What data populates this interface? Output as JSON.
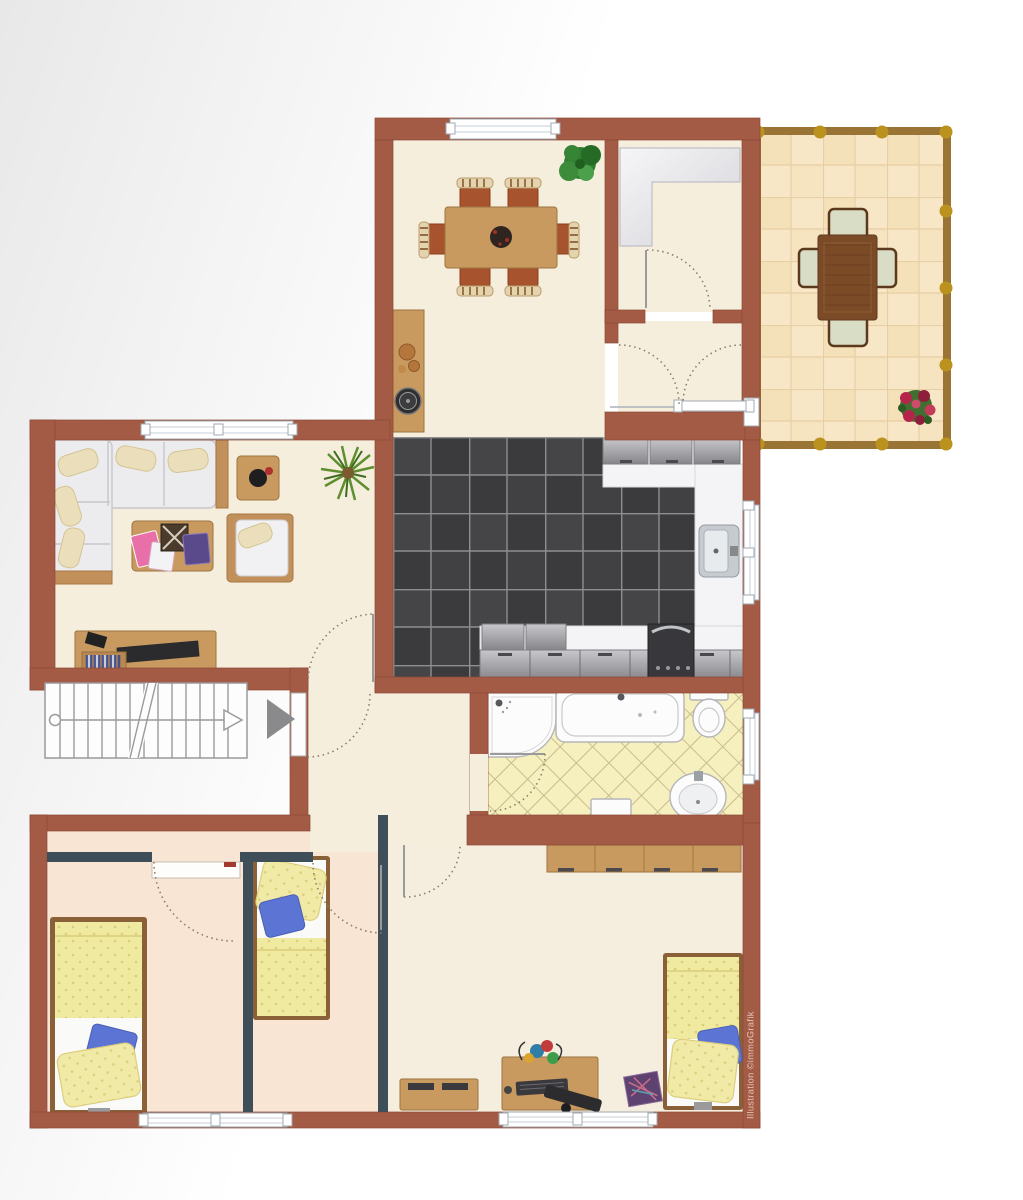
{
  "illustration": {
    "watermark": "Illustration ©immoGrafik",
    "type": "apartment floor plan"
  },
  "rooms": [
    {
      "name": "dining-room"
    },
    {
      "name": "storage-closet"
    },
    {
      "name": "vestibule"
    },
    {
      "name": "terrace"
    },
    {
      "name": "living-room"
    },
    {
      "name": "kitchen"
    },
    {
      "name": "hallway"
    },
    {
      "name": "bathroom"
    },
    {
      "name": "stairwell"
    },
    {
      "name": "bedroom-left"
    },
    {
      "name": "bedroom-middle"
    },
    {
      "name": "bedroom-main"
    }
  ],
  "colors": {
    "wall": "#A35B46",
    "wallEdge": "#8B4936",
    "partition": "#3E4F59",
    "floorCream": "#F6EEDD",
    "floorPink": "#F9E5D4",
    "terraceFrame": "#9A7434",
    "terraceKnob": "#BC921F",
    "bathTile": "#F5F0BE",
    "bathTileLine": "#CBBC90",
    "woodLight": "#C99A60",
    "woodEdge": "#9A743F",
    "terraceWood": "#7B4B28",
    "chairTerracotta": "#A6532E",
    "sofaFabric": "#ECECEF",
    "pillowCream": "#EBDFBB",
    "blanketYellow": "#F0E9A0",
    "pillowBlue": "#5C74D4",
    "bedFrame": "#8A6038",
    "fixtureWhite": "#FCFCFD",
    "fixtureEdge": "#B5B5B8",
    "arcColor": "#8A7F6B",
    "stairGrey": "#9A9A9C",
    "arrowGrey": "#8A8A8C"
  }
}
